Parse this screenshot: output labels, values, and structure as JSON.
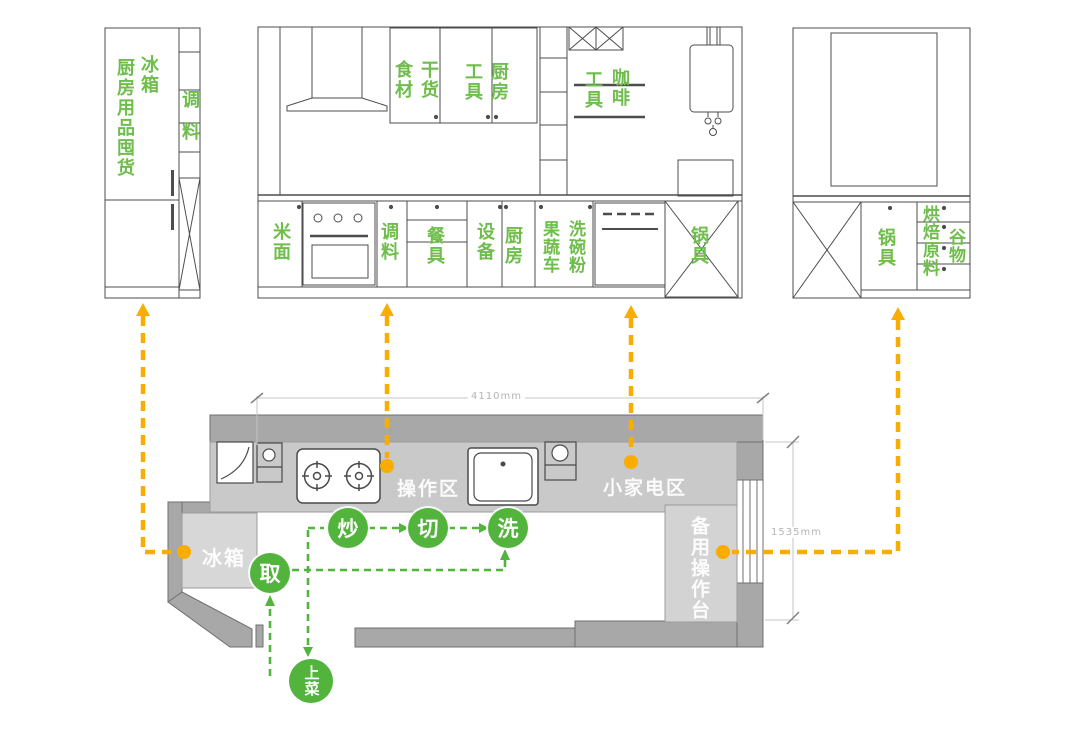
{
  "colors": {
    "label_green": "#6fbd4c",
    "circle_green": "#52b43c",
    "arrow_orange": "#f8ad00",
    "wall_gray": "#a8a8a8",
    "counter_gray": "#c9c9c9",
    "block_gray": "#d7d7d7"
  },
  "elevations": {
    "left": {
      "fridge": "冰箱",
      "stock": "厨房用品囤货",
      "seasoning": "调料"
    },
    "middle": {
      "food": "食材",
      "dry": "干货",
      "tools_top": "工具",
      "kitchen_top": "厨房",
      "tools_shelf": "工具",
      "coffee": "咖啡",
      "rice": "米面",
      "seasoning": "调料",
      "tableware": "餐具",
      "equipment": "设备",
      "kitchen_base": "厨房",
      "veg_cart": "果蔬车",
      "wash_powder": "洗碗粉",
      "pots": "锅具"
    },
    "right": {
      "pots": "锅具",
      "baking": "烘焙原料",
      "grain": "谷物"
    }
  },
  "plan": {
    "dim_w": "4110mm",
    "dim_d": "1535mm",
    "zone_operation": "操作区",
    "zone_appliance": "小家电区",
    "zone_fridge": "冰箱",
    "zone_backup": "备用操作台",
    "steps": {
      "take": "取",
      "wash": "洗",
      "cut": "切",
      "fry": "炒",
      "serve": "上菜"
    }
  }
}
